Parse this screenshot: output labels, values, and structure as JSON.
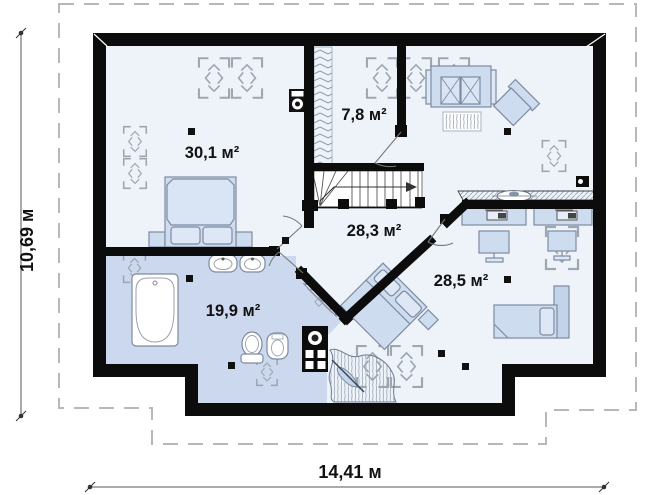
{
  "rooms": [
    {
      "id": "bedroom-1",
      "label": "30,1 м²"
    },
    {
      "id": "wardrobe",
      "label": "7,8 м²"
    },
    {
      "id": "hall",
      "label": "28,3 м²"
    },
    {
      "id": "bathroom",
      "label": "19,9 м²"
    },
    {
      "id": "bedroom-2",
      "label": "28,5 м²"
    }
  ],
  "dimensions": {
    "width_label": "14,41 м",
    "height_label": "10,69 м"
  },
  "colors": {
    "wall": "#0c0c0c",
    "floor": "#eef3f9",
    "bathroom_floor": "#cbd8ed",
    "furniture_fill": "#cedcf0",
    "furniture_stroke": "#7d8ba1",
    "roof_outline": "#b8b8b8",
    "symbol_gray": "#98a2ad"
  }
}
